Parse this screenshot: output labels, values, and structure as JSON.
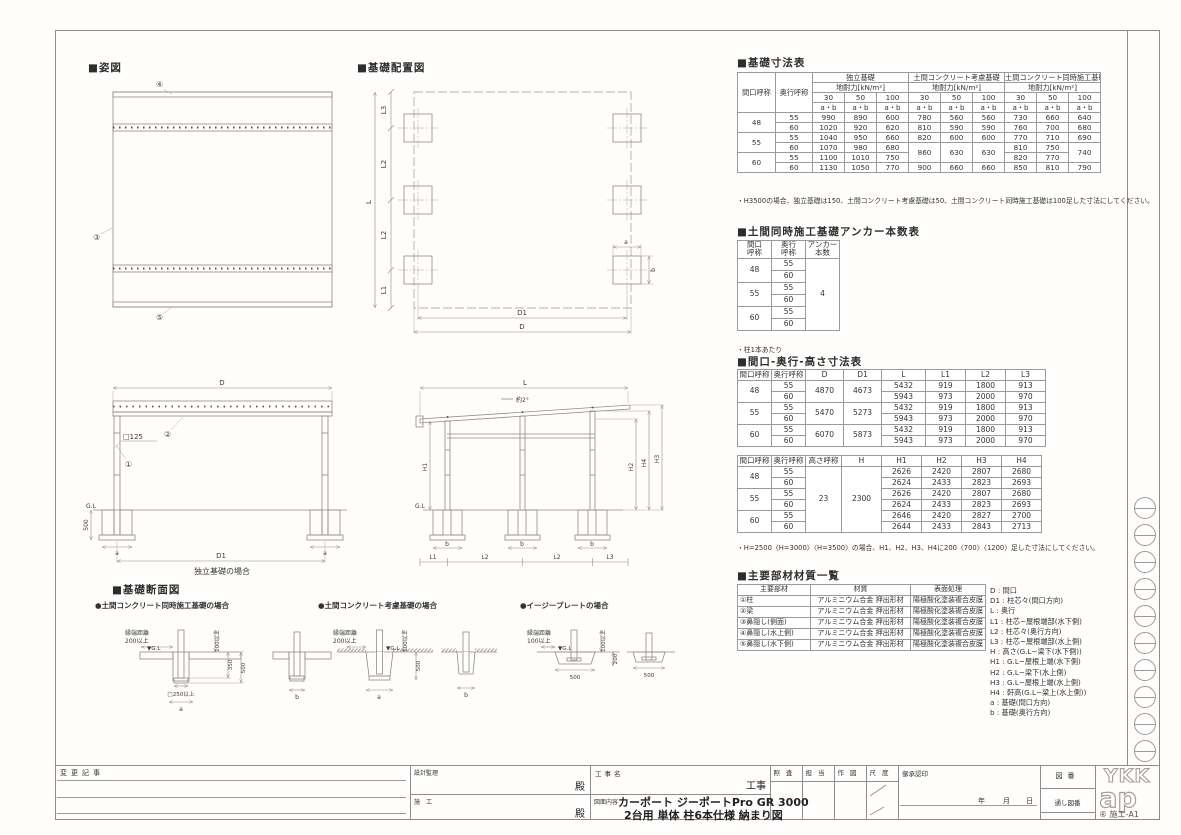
{
  "sheet": {
    "logo_top": "YKK",
    "logo_bottom": "ap",
    "frame_label": "® 施工-A1"
  },
  "sections": {
    "appearance": "■姿図",
    "layout": "■基礎配置図",
    "cross_section": "■基礎断面図"
  },
  "marks": {
    "m1": "①",
    "m2": "②",
    "m3": "③",
    "m4": "④",
    "m5": "⑤"
  },
  "front_elev": {
    "dim_d": "D",
    "dim_d1": "D1",
    "col_size": "□125",
    "gl": "G.L",
    "dim_500": "500",
    "dim_a": "a",
    "caption": "独立基礎の場合"
  },
  "side_elev": {
    "dim_l": "L",
    "slope": "約2°",
    "gl": "G.L",
    "h1": "H1",
    "h2": "H2",
    "h3": "H3",
    "h4": "H4",
    "l1": "L1",
    "l2": "L2",
    "l3": "L3",
    "b": "b"
  },
  "layout_plan": {
    "l": "L",
    "l1": "L1",
    "l2": "L2",
    "l3": "L3",
    "d": "D",
    "d1": "D1",
    "a": "a",
    "b": "b"
  },
  "cross_sections": {
    "case1": {
      "title": "●土間コンクリート同時施工基礎の場合",
      "edge1": "縁端距離",
      "edge2": "200以上",
      "gl": "▼G.L",
      "v100": "100以上",
      "v350": "350",
      "v500": "500",
      "v250": "□250以上",
      "a": "a",
      "b": "b"
    },
    "case2": {
      "title": "●土間コンクリート考慮基礎の場合",
      "edge1": "縁端距離",
      "edge2": "200以上",
      "gl": "▼G.L",
      "v100": "100以上",
      "v500": "500",
      "a": "a",
      "b": "b"
    },
    "case3": {
      "title": "●イージープレートの場合",
      "edge1": "縁端距離",
      "edge2": "100以上",
      "gl": "▼G.L",
      "v100": "100以上",
      "v200": "200",
      "v500a": "500",
      "v500b": "500"
    }
  },
  "t1": {
    "title": "■基礎寸法表",
    "rows": [
      [
        {
          "t": "間口呼称",
          "rs": 4
        },
        {
          "t": "奥行呼称",
          "rs": 4
        },
        {
          "t": "独立基礎",
          "cs": 3
        },
        {
          "t": "土間コンクリート考慮基礎",
          "cs": 3
        },
        {
          "t": "土間コンクリート同時施工基礎",
          "cs": 3
        }
      ],
      [
        {
          "t": "地耐力[kN/m²]",
          "cs": 3
        },
        {
          "t": "地耐力[kN/m²]",
          "cs": 3
        },
        {
          "t": "地耐力[kN/m²]",
          "cs": 3
        }
      ],
      [
        "30",
        "50",
        "100",
        "30",
        "50",
        "100",
        "30",
        "50",
        "100"
      ],
      [
        "a・b",
        "a・b",
        "a・b",
        "a・b",
        "a・b",
        "a・b",
        "a・b",
        "a・b",
        "a・b"
      ],
      [
        {
          "t": "48",
          "rs": 2
        },
        "55",
        "990",
        "890",
        "600",
        "780",
        "560",
        "560",
        "730",
        "660",
        "640"
      ],
      [
        "60",
        "1020",
        "920",
        "620",
        "810",
        "590",
        "590",
        "760",
        "700",
        "680"
      ],
      [
        {
          "t": "55",
          "rs": 2
        },
        "55",
        "1040",
        "950",
        "660",
        "820",
        "600",
        "600",
        "770",
        "710",
        "690"
      ],
      [
        "60",
        "1070",
        "980",
        "680",
        {
          "t": "860",
          "rs": 2
        },
        {
          "t": "630",
          "rs": 2
        },
        {
          "t": "630",
          "rs": 2
        },
        "810",
        "750",
        {
          "t": "740",
          "rs": 2
        }
      ],
      [
        {
          "t": "60",
          "rs": 2
        },
        "55",
        "1100",
        "1010",
        "750",
        "820",
        "770"
      ],
      [
        "60",
        "1130",
        "1050",
        "770",
        "900",
        "660",
        "660",
        "850",
        "810",
        "790"
      ]
    ],
    "note": "・H3500の場合、独立基礎は150、土間コンクリート考慮基礎は50、土間コンクリート同時施工基礎は100足した寸法にしてください。"
  },
  "t2": {
    "title": "■土間同時施工基礎アンカー本数表",
    "rows": [
      [
        "間口\n呼称",
        "奥行\n呼称",
        "アンカー\n本数"
      ],
      [
        {
          "t": "48",
          "rs": 2
        },
        "55",
        {
          "t": "4",
          "rs": 6
        }
      ],
      [
        "60"
      ],
      [
        {
          "t": "55",
          "rs": 2
        },
        "55"
      ],
      [
        "60"
      ],
      [
        {
          "t": "60",
          "rs": 2
        },
        "55"
      ],
      [
        "60"
      ]
    ],
    "note": "・柱1本あたり"
  },
  "t3": {
    "title": "■間口-奥行-高さ寸法表",
    "rows_a": [
      [
        "間口呼称",
        "奥行呼称",
        "D",
        "D1",
        "L",
        "L1",
        "L2",
        "L3"
      ],
      [
        {
          "t": "48",
          "rs": 2
        },
        "55",
        {
          "t": "4870",
          "rs": 2
        },
        {
          "t": "4673",
          "rs": 2
        },
        "5432",
        "919",
        "1800",
        "913"
      ],
      [
        "60",
        "5943",
        "973",
        "2000",
        "970"
      ],
      [
        {
          "t": "55",
          "rs": 2
        },
        "55",
        {
          "t": "5470",
          "rs": 2
        },
        {
          "t": "5273",
          "rs": 2
        },
        "5432",
        "919",
        "1800",
        "913"
      ],
      [
        "60",
        "5943",
        "973",
        "2000",
        "970"
      ],
      [
        {
          "t": "60",
          "rs": 2
        },
        "55",
        {
          "t": "6070",
          "rs": 2
        },
        {
          "t": "5873",
          "rs": 2
        },
        "5432",
        "919",
        "1800",
        "913"
      ],
      [
        "60",
        "5943",
        "973",
        "2000",
        "970"
      ]
    ],
    "rows_b": [
      [
        "間口呼称",
        "奥行呼称",
        "高さ呼称",
        "H",
        "H1",
        "H2",
        "H3",
        "H4"
      ],
      [
        {
          "t": "48",
          "rs": 2
        },
        "55",
        {
          "t": "23",
          "rs": 6
        },
        {
          "t": "2300",
          "rs": 6
        },
        "2626",
        "2420",
        "2807",
        "2680"
      ],
      [
        "60",
        "2624",
        "2433",
        "2823",
        "2693"
      ],
      [
        {
          "t": "55",
          "rs": 2
        },
        "55",
        "2626",
        "2420",
        "2807",
        "2680"
      ],
      [
        "60",
        "2624",
        "2433",
        "2823",
        "2693"
      ],
      [
        {
          "t": "60",
          "rs": 2
        },
        "55",
        "2646",
        "2420",
        "2827",
        "2700"
      ],
      [
        "60",
        "2644",
        "2433",
        "2843",
        "2713"
      ]
    ],
    "note": "・H=2500〈H=3000〉〈H=3500〉の場合、H1、H2、H3、H4に200〈700〉〈1200〉足した寸法にしてください。"
  },
  "t4": {
    "title": "■主要部材材質一覧",
    "rows": [
      [
        "主要部材",
        "材質",
        "表面処理"
      ],
      [
        "①柱",
        "アルミニウム合金 押出形材",
        "陽極酸化塗装複合皮膜"
      ],
      [
        "②梁",
        "アルミニウム合金 押出形材",
        "陽極酸化塗装複合皮膜"
      ],
      [
        "③鼻隠し(側面)",
        "アルミニウム合金 押出形材",
        "陽極酸化塗装複合皮膜"
      ],
      [
        "④鼻隠し(水上側)",
        "アルミニウム合金 押出形材",
        "陽極酸化塗装複合皮膜"
      ],
      [
        "⑤鼻隠し(水下側)",
        "アルミニウム合金 押出形材",
        "陽極酸化塗装複合皮膜"
      ]
    ]
  },
  "legend": [
    "D : 間口",
    "D1 : 柱芯々(間口方向)",
    "L : 奥行",
    "L1 : 柱芯~屋根端部(水下側)",
    "L2 : 柱芯々(奥行方向)",
    "L3 : 柱芯~屋根端部(水上側)",
    "H : 高さ(G.L~梁下(水下側))",
    "H1 : G.L~屋根上端(水下側)",
    "H2 : G.L~梁下(水上側)",
    "H3 : G.L~屋根上端(水上側)",
    "H4 : 軒高(G.L~梁上(水上側))",
    "a : 基礎(間口方向)",
    "b : 基礎(奥行方向)"
  ],
  "titleblock": {
    "change_notes": "変更記事",
    "design_supervision": "設計監理",
    "dono1": "殿",
    "contractor": "施工",
    "dono2": "殿",
    "project_label": "工事名",
    "project_suffix": "工事",
    "drawing_label": "図面内容",
    "product_line1": "カーポート ジーポートPro GR 3000",
    "product_line2": "2台用 単体 柱6本仕様 納まり図",
    "col_check": "照査",
    "col_charge": "担当",
    "col_draw": "作図",
    "col_scale": "尺度",
    "approval": "御承認印",
    "year": "年",
    "month": "月",
    "day": "日",
    "drawing_no": "図番",
    "serial_no": "通し図番"
  }
}
